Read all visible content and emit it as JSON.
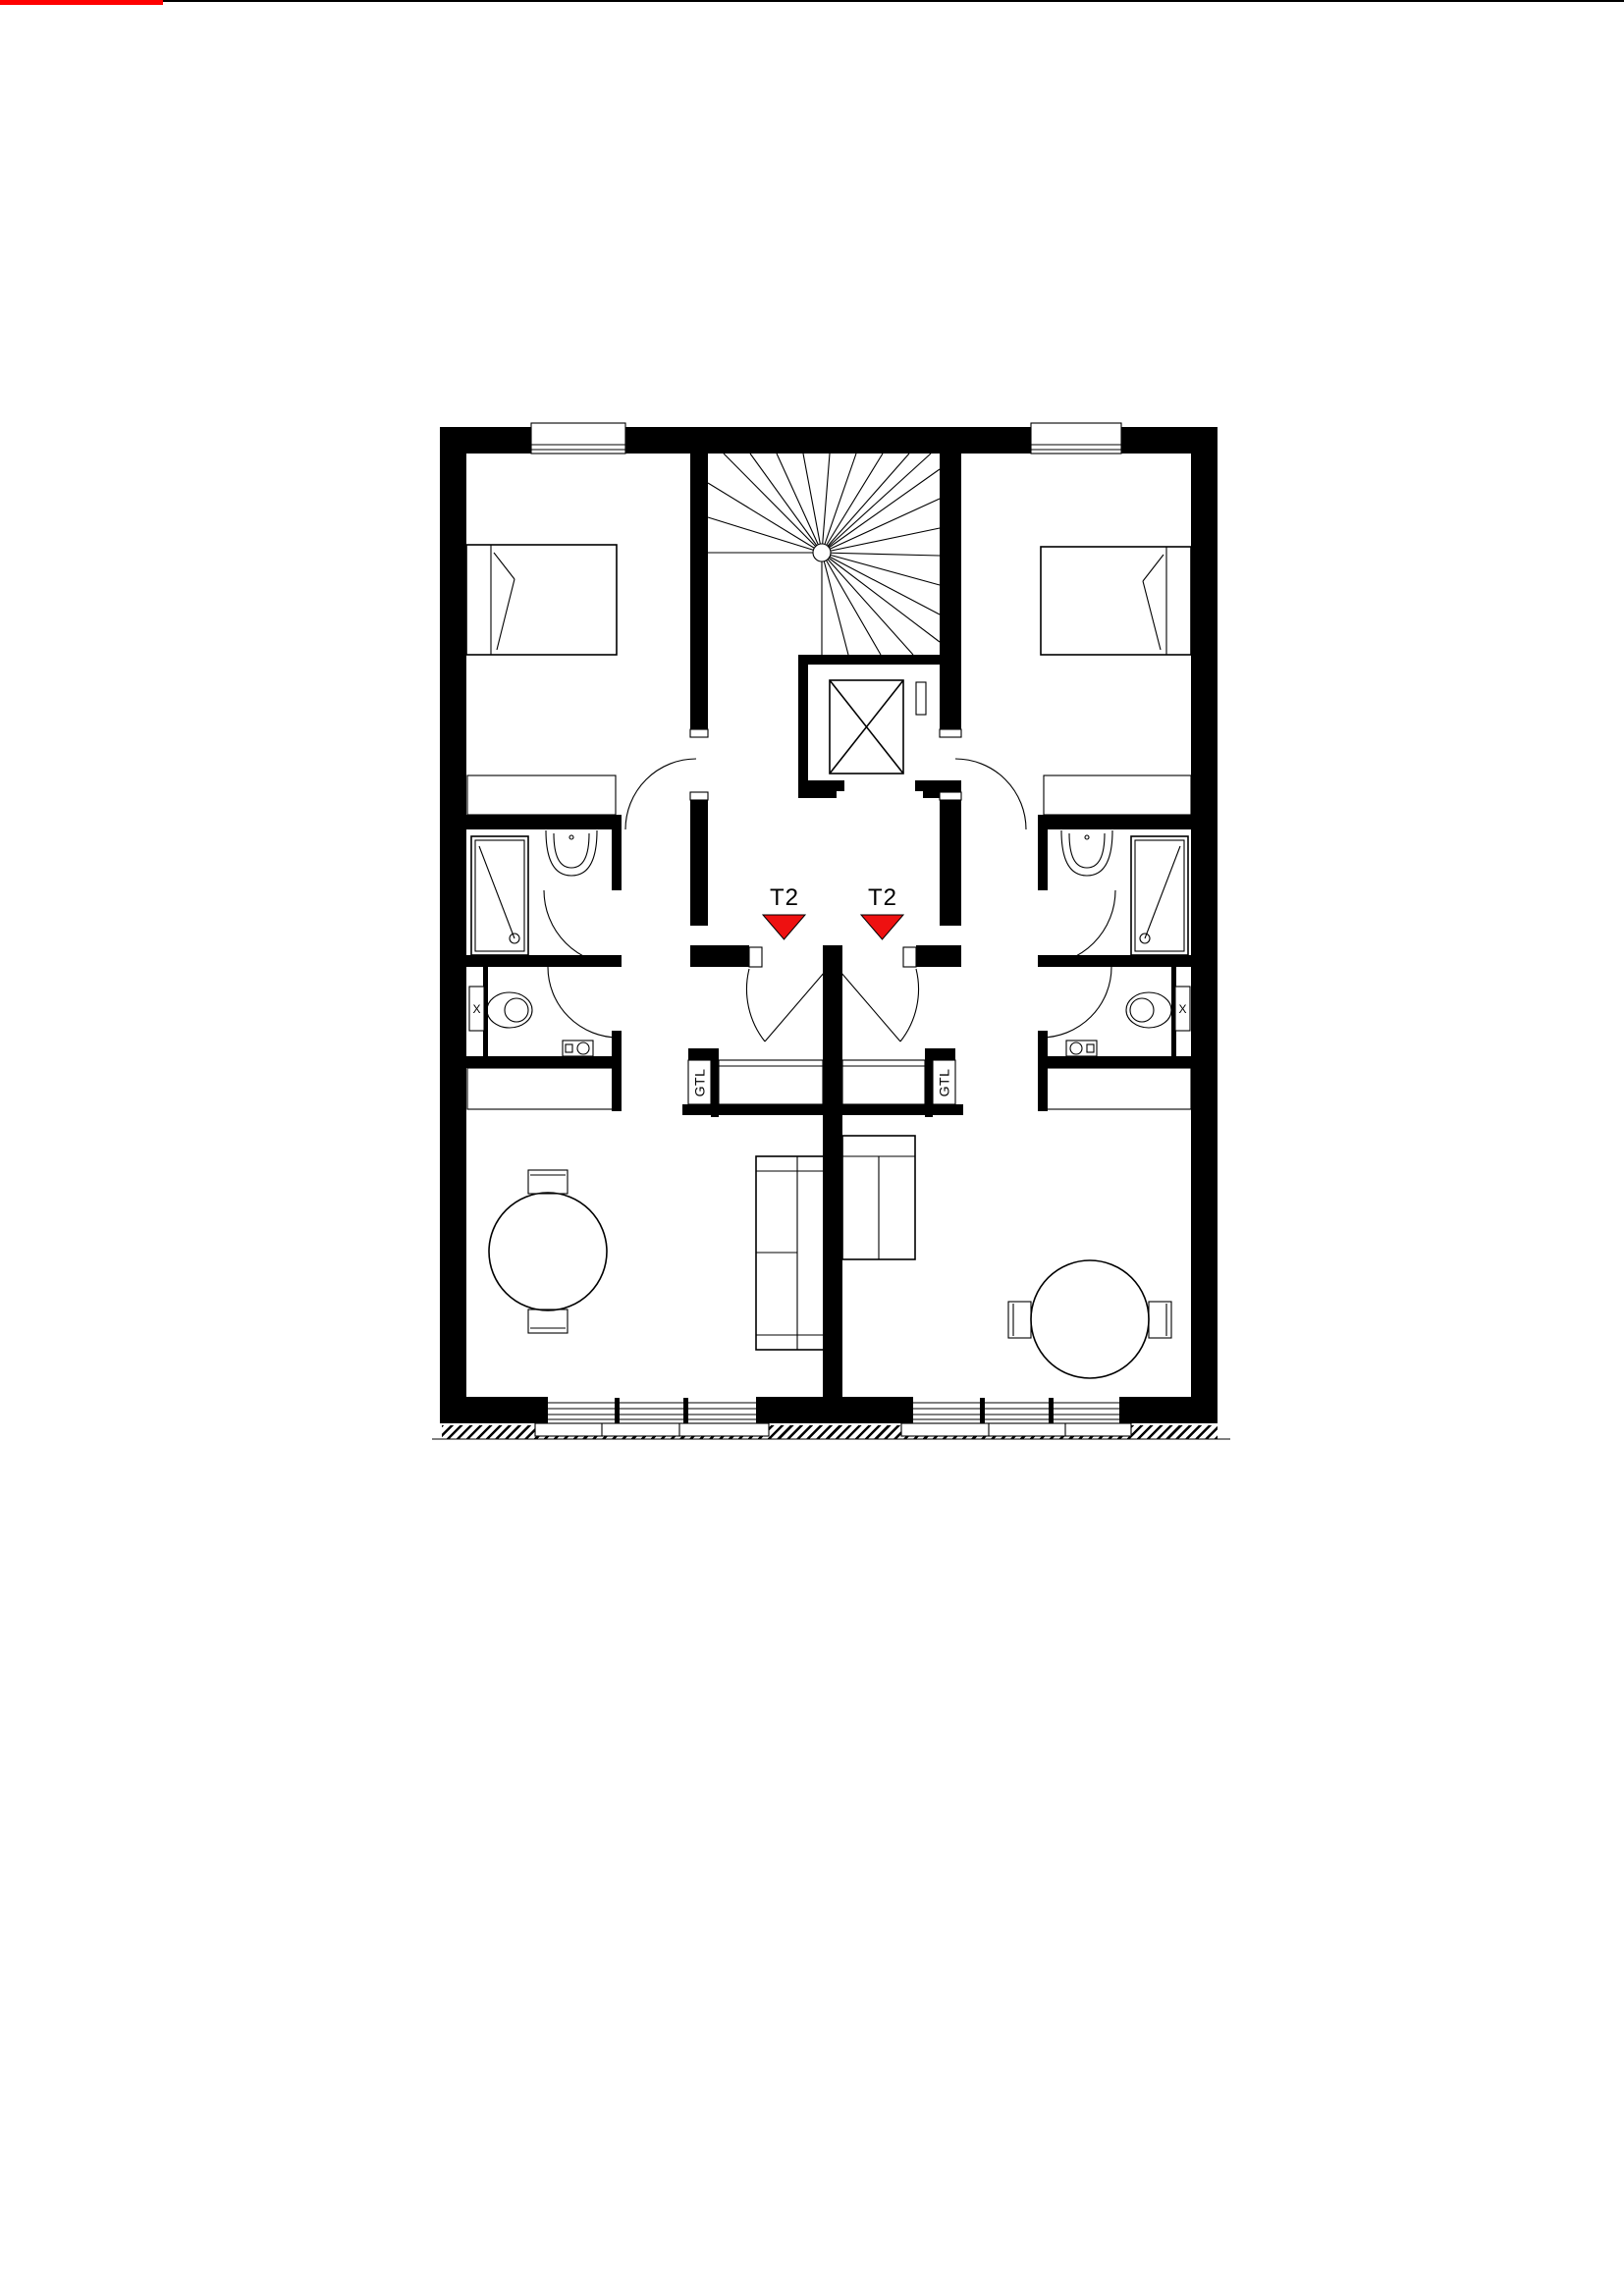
{
  "colors": {
    "wall": "#000000",
    "line": "#000000",
    "marker": "#ee1111",
    "accent": "#ff0000",
    "bg": "#ffffff"
  },
  "plan": {
    "units": [
      {
        "label": "T2"
      },
      {
        "label": "T2"
      }
    ],
    "gtl": [
      {
        "label": "GTL"
      },
      {
        "label": "GTL"
      }
    ],
    "window_markers": [
      {
        "label": "X"
      },
      {
        "label": "X"
      }
    ]
  }
}
